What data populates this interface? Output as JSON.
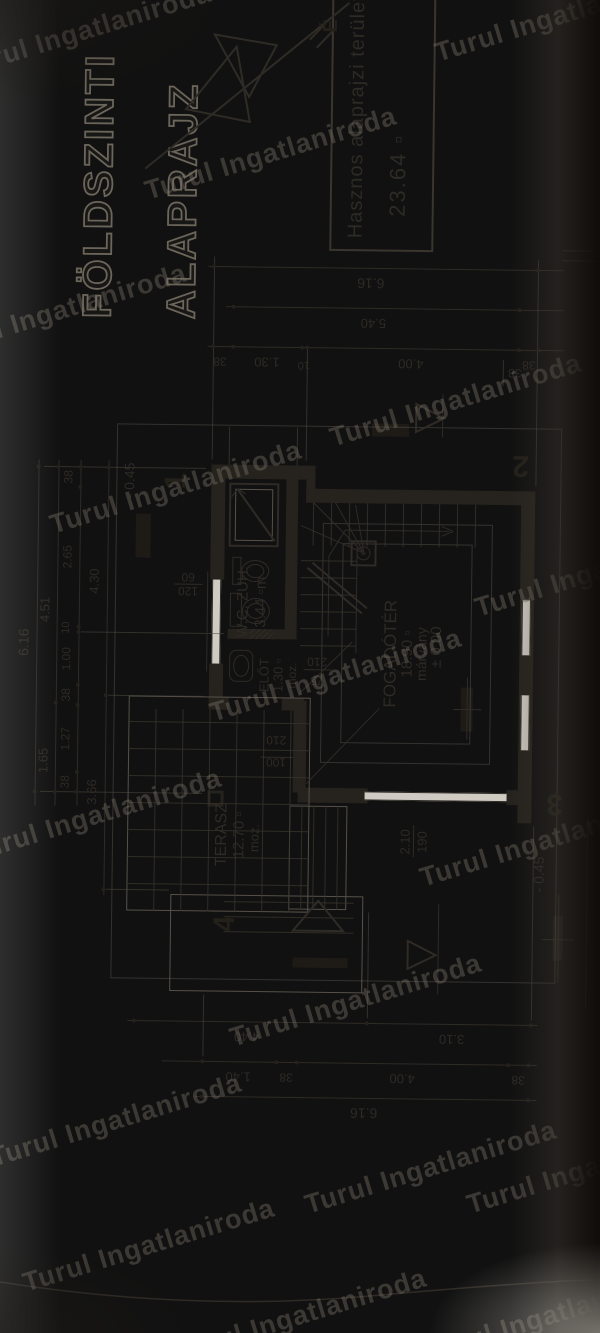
{
  "drawing_title": {
    "line1": "FÖLDSZINTI",
    "line2": "ALAPRAJZ"
  },
  "info_box": {
    "line1": "Hasznos alaprajzi terület",
    "line2": "23.64 ▫"
  },
  "watermark": {
    "text": "Turul Ingatlaniroda",
    "positions": [
      [
        -45,
        15
      ],
      [
        430,
        0
      ],
      [
        140,
        138
      ],
      [
        -70,
        295
      ],
      [
        325,
        385
      ],
      [
        45,
        472
      ],
      [
        470,
        555
      ],
      [
        205,
        660
      ],
      [
        -35,
        800
      ],
      [
        415,
        825
      ],
      [
        225,
        985
      ],
      [
        -15,
        1105
      ],
      [
        300,
        1152
      ],
      [
        18,
        1230
      ],
      [
        462,
        1152
      ],
      [
        170,
        1300
      ],
      [
        420,
        1300
      ]
    ]
  },
  "north_label": "É",
  "rooms": [
    {
      "name": "FOGADÓTÉR",
      "area": "18.90 ▫",
      "floor": "márvány",
      "level": "± 0.00"
    },
    {
      "name": "TERASZ",
      "area": "12.70 ▫",
      "floor": "moz."
    },
    {
      "name": "W.C. ZUH.",
      "area": "3.44 ▫m"
    },
    {
      "name": "ELŐT",
      "area": "1.30 ▫",
      "floor": "moz."
    }
  ],
  "section_markers": [
    "1",
    "2",
    "3",
    "4"
  ],
  "levels": [
    "- 0.45",
    "± 0.00",
    "- 0.45"
  ],
  "openings": [
    "75/210",
    "100/210",
    "120/60",
    "2.10/190"
  ],
  "dimension_chains": {
    "top": [
      [
        "6.16"
      ],
      [
        "1.65",
        "4.51"
      ],
      [
        "38",
        "1.27",
        "38",
        "1.00",
        "10",
        "2.65",
        "38"
      ],
      [
        "3.66",
        "4.30"
      ]
    ],
    "right": [
      [
        "6.16"
      ],
      [
        "5.40"
      ],
      [
        "38",
        "1.30",
        "10",
        "4.00",
        "38"
      ]
    ],
    "bottom": [
      [
        "4.40",
        "3.10"
      ],
      [
        "1.40",
        "38",
        "4.00",
        "38"
      ],
      [
        "6.16"
      ]
    ]
  },
  "plan": {
    "rects": [
      {
        "x": 856,
        "y": 198,
        "w": 14,
        "h": 100,
        "c": "w"
      },
      {
        "x": 833,
        "y": 293,
        "w": 37,
        "h": 9,
        "c": "w"
      },
      {
        "x": 833,
        "y": 293,
        "w": 14,
        "h": 229,
        "c": "w"
      },
      {
        "x": 515,
        "y": 508,
        "w": 332,
        "h": 14,
        "c": "w"
      },
      {
        "x": 533,
        "y": 288,
        "w": 15,
        "h": 70,
        "c": "w"
      },
      {
        "x": 533,
        "y": 497,
        "w": 15,
        "h": 25,
        "c": "w"
      },
      {
        "x": 633,
        "y": 198,
        "w": 38,
        "h": 14,
        "c": "w"
      },
      {
        "x": 755,
        "y": 198,
        "w": 115,
        "h": 14,
        "c": "w"
      },
      {
        "x": 625,
        "y": 198,
        "w": 13,
        "h": 20,
        "c": "w"
      },
      {
        "x": 625,
        "y": 271,
        "w": 13,
        "h": 22,
        "c": "w"
      },
      {
        "x": 543,
        "y": 283,
        "w": 92,
        "h": 13,
        "c": "w"
      },
      {
        "x": 696,
        "y": 273,
        "w": 174,
        "h": 12,
        "c": "w"
      },
      {
        "x": 696,
        "y": 216,
        "w": 10,
        "h": 62,
        "c": "w"
      },
      {
        "x": 900,
        "y": 358,
        "w": 13,
        "h": 37,
        "c": "blk"
      },
      {
        "x": 776,
        "y": 123,
        "w": 44,
        "h": 15,
        "c": "blk"
      },
      {
        "x": 378,
        "y": 545,
        "w": 45,
        "h": 10,
        "c": "blk"
      },
      {
        "x": 368,
        "y": 285,
        "w": 10,
        "h": 55,
        "c": "blk"
      },
      {
        "x": 606,
        "y": 450,
        "w": 44,
        "h": 12,
        "c": "blk"
      },
      {
        "x": 536,
        "y": 355,
        "w": 9,
        "h": 142,
        "c": "winv"
      },
      {
        "x": 671,
        "y": 200,
        "w": 84,
        "h": 9,
        "c": "winh"
      },
      {
        "x": 588,
        "y": 510,
        "w": 55,
        "h": 9,
        "c": "winh"
      },
      {
        "x": 683,
        "y": 510,
        "w": 55,
        "h": 9,
        "c": "winh"
      },
      {
        "x": 423,
        "y": 118,
        "w": 215,
        "h": 182,
        "c": "o"
      },
      {
        "x": 426,
        "y": 280,
        "w": 104,
        "h": 58,
        "c": "o"
      },
      {
        "x": 343,
        "y": 162,
        "w": 97,
        "h": 193,
        "c": "o"
      },
      {
        "x": 355,
        "y": 103,
        "w": 555,
        "h": 445,
        "c": "faint"
      },
      {
        "x": 573,
        "y": 310,
        "w": 240,
        "h": 170,
        "c": "faint"
      },
      {
        "x": 593,
        "y": 330,
        "w": 200,
        "h": 130,
        "c": "faint"
      },
      {
        "x": 788,
        "y": 216,
        "w": 64,
        "h": 50,
        "c": "ob"
      },
      {
        "x": 794,
        "y": 222,
        "w": 52,
        "h": 38,
        "c": "o"
      },
      {
        "x": 770,
        "y": 338,
        "w": 26,
        "h": 26,
        "c": "ob"
      },
      {
        "x": 528,
        "y": 198,
        "w": 16,
        "h": 16,
        "c": "col"
      },
      {
        "x": 750,
        "y": 220,
        "w": 28,
        "h": 9,
        "c": "o2"
      },
      {
        "x": 708,
        "y": 218,
        "w": 34,
        "h": 12,
        "c": "o2"
      },
      {
        "x": 653,
        "y": 218,
        "w": 32,
        "h": 24,
        "c": "o2",
        "r": 7
      },
      {
        "x": 696,
        "y": 238,
        "w": 10,
        "h": 24,
        "c": "hatch"
      },
      {
        "x": 1085,
        "y": 313,
        "w": 258,
        "h": 104,
        "c": "box"
      }
    ],
    "lines": [
      [
        527,
        25,
        873,
        25
      ],
      [
        527,
        45,
        873,
        45
      ],
      [
        527,
        67,
        873,
        67
      ],
      [
        438,
        95,
        873,
        95
      ],
      [
        1068,
        192,
        1068,
        548
      ],
      [
        1028,
        210,
        1028,
        548
      ],
      [
        988,
        192,
        988,
        548
      ],
      [
        313,
        120,
        313,
        530
      ],
      [
        273,
        155,
        273,
        530
      ],
      [
        238,
        188,
        238,
        530
      ],
      [
        541,
        30,
        541,
        192,
        1,
        "t2"
      ],
      [
        866,
        30,
        866,
        192,
        1,
        "t2"
      ],
      [
        638,
        97,
        638,
        192,
        1,
        "t2"
      ],
      [
        444,
        97,
        444,
        160,
        1,
        "t2"
      ],
      [
        701,
        69,
        701,
        212,
        1,
        "t2"
      ],
      [
        875,
        198,
        1078,
        198,
        1,
        "t2"
      ],
      [
        852,
        522,
        1078,
        522,
        1,
        "t2"
      ],
      [
        875,
        292,
        990,
        292,
        1,
        "t2"
      ],
      [
        318,
        524,
        512,
        524,
        1,
        "t2"
      ],
      [
        318,
        360,
        424,
        360,
        1,
        "t2"
      ],
      [
        278,
        196,
        340,
        196,
        1,
        "t2"
      ],
      [
        870,
        215,
        908,
        215,
        1,
        "t2"
      ],
      [
        870,
        283,
        908,
        283,
        1,
        "t2"
      ],
      [
        683,
        344,
        790,
        344
      ],
      [
        723,
        350,
        768,
        295,
        2
      ],
      [
        728,
        355,
        773,
        300,
        2
      ],
      [
        783,
        351,
        810,
        288
      ],
      [
        783,
        351,
        833,
        300
      ],
      [
        783,
        351,
        833,
        322
      ],
      [
        783,
        351,
        831,
        342
      ],
      [
        700,
        316,
        780,
        316
      ],
      [
        780,
        316,
        806,
        332
      ],
      [
        806,
        332,
        806,
        436
      ],
      [
        801,
        428,
        806,
        440
      ],
      [
        811,
        428,
        806,
        440
      ],
      [
        794,
        262,
        846,
        224,
        2
      ],
      [
        838,
        218,
        846,
        224
      ],
      [
        841,
        232,
        846,
        224
      ],
      [
        552,
        296,
        628,
        368
      ],
      [
        642,
        288,
        694,
        340
      ],
      [
        663,
        195,
        763,
        195
      ],
      [
        666,
        292,
        666,
        320
      ],
      [
        578,
        250,
        578,
        283
      ],
      [
        750,
        162,
        750,
        190
      ],
      [
        480,
        404,
        512,
        404
      ],
      [
        330,
        578,
        520,
        578,
        1,
        "t2"
      ],
      [
        1078,
        546,
        1078,
        600,
        1,
        "t2"
      ],
      [
        1088,
        546,
        1088,
        600,
        1,
        "t2"
      ],
      [
        1165,
        128,
        1333,
        330,
        2
      ],
      [
        1288,
        298,
        1305,
        314,
        2
      ],
      [
        1296,
        291,
        1313,
        307,
        2
      ],
      [
        356,
        550,
        444,
        550
      ],
      [
        399,
        534,
        399,
        566
      ],
      [
        598,
        456,
        660,
        456
      ],
      [
        628,
        442,
        628,
        470
      ],
      [
        900,
        428,
        943,
        428
      ],
      [
        343,
        430,
        433,
        430
      ],
      [
        952,
        488,
        978,
        488,
        1,
        "t2"
      ]
    ],
    "treads": [
      {
        "d": "v",
        "x": 690,
        "y": 288,
        "len": 56,
        "step": 17,
        "n": 6
      },
      {
        "d": "h",
        "x": 790,
        "y": 300,
        "len": 43,
        "step": 18,
        "n": 10
      },
      {
        "d": "h",
        "x": 426,
        "y": 292,
        "len": 104,
        "step": 12,
        "n": 4
      },
      {
        "d": "v",
        "x": 403,
        "y": 215,
        "len": 130,
        "step": 15,
        "n": 3
      }
    ],
    "grid": {
      "x": 423,
      "y": 118,
      "w": 202,
      "h": 182,
      "step": 27
    },
    "dots": [
      [
        541,
        25
      ],
      [
        866,
        25
      ],
      [
        541,
        45
      ],
      [
        630,
        45
      ],
      [
        866,
        45
      ],
      [
        541,
        67
      ],
      [
        561,
        67
      ],
      [
        628,
        67
      ],
      [
        648,
        67
      ],
      [
        701,
        67
      ],
      [
        706,
        67
      ],
      [
        846,
        67
      ],
      [
        866,
        67
      ],
      [
        444,
        95
      ],
      [
        638,
        95
      ],
      [
        866,
        95
      ],
      [
        1068,
        198
      ],
      [
        1068,
        522
      ],
      [
        1028,
        218
      ],
      [
        1028,
        504
      ],
      [
        988,
        198
      ],
      [
        988,
        218
      ],
      [
        988,
        287
      ],
      [
        988,
        292
      ],
      [
        988,
        504
      ],
      [
        988,
        524
      ],
      [
        313,
        127
      ],
      [
        313,
        360
      ],
      [
        313,
        524
      ],
      [
        273,
        196
      ],
      [
        273,
        270
      ],
      [
        273,
        290
      ],
      [
        273,
        502
      ],
      [
        273,
        522
      ],
      [
        238,
        196
      ],
      [
        238,
        522
      ],
      [
        783,
        351
      ]
    ],
    "ells": [
      [
        753,
        229,
        22,
        28
      ],
      [
        757,
        234,
        14,
        18
      ],
      [
        711,
        230,
        26,
        28
      ],
      [
        716,
        235,
        16,
        18
      ],
      [
        658,
        222,
        22,
        16
      ],
      [
        776,
        344,
        14,
        14
      ]
    ],
    "polys": [
      "905,402 933,402 919,430",
      "368,400 396,400 382,428",
      "405,335 435,310 405,285",
      "1225,168 1288,218 1213,232",
      "1238,231 1300,196 1290,258"
    ],
    "texts": [
      [
        "W.C. ZUH.",
        733,
        231,
        15
      ],
      [
        "3.44 ▫m",
        733,
        249,
        15
      ],
      [
        "ELŐT",
        660,
        253,
        13
      ],
      [
        "1.30 ▫",
        660,
        267,
        13
      ],
      [
        "moz.",
        660,
        281,
        12
      ],
      [
        "FOGADÓTÉR",
        683,
        379,
        17
      ],
      [
        "18.90 ▫",
        683,
        396,
        15
      ],
      [
        "márvány",
        683,
        410,
        14
      ],
      [
        "± 0.00",
        690,
        425,
        15
      ],
      [
        "TERASZ",
        500,
        213,
        16
      ],
      [
        "12.70 ▫",
        500,
        230,
        15
      ],
      [
        "moz.",
        497,
        245,
        13
      ],
      [
        "6.16",
        690,
        12,
        14
      ],
      [
        "1.65",
        572,
        33,
        13
      ],
      [
        "4.51",
        723,
        33,
        13
      ],
      [
        "38",
        551,
        55,
        12
      ],
      [
        "1.27",
        594,
        55,
        12
      ],
      [
        "38",
        638,
        55,
        12
      ],
      [
        "1.00",
        674,
        55,
        12
      ],
      [
        "10",
        705,
        55,
        11
      ],
      [
        "2.65",
        776,
        55,
        12
      ],
      [
        "38",
        856,
        55,
        12
      ],
      [
        "3.66",
        541,
        82,
        13
      ],
      [
        "4.30",
        752,
        82,
        13
      ],
      [
        "6.16",
        1053,
        355,
        14,
        -90
      ],
      [
        "5.40",
        1013,
        358,
        13,
        -90
      ],
      [
        "38",
        973,
        205,
        12,
        -90
      ],
      [
        "1.30",
        973,
        252,
        13,
        -90
      ],
      [
        "10",
        971,
        289,
        11,
        -90
      ],
      [
        "4.00",
        973,
        396,
        13,
        -90
      ],
      [
        "38",
        973,
        514,
        12,
        -90
      ],
      [
        "4.40",
        298,
        240,
        13,
        -90
      ],
      [
        "3.10",
        298,
        445,
        13,
        -90
      ],
      [
        "1.40",
        258,
        232,
        13,
        -90
      ],
      [
        "38",
        258,
        280,
        12,
        -90
      ],
      [
        "4.00",
        258,
        396,
        13,
        -90
      ],
      [
        "38",
        258,
        512,
        12,
        -90
      ],
      [
        "6.16",
        223,
        358,
        14,
        -90
      ],
      [
        "75",
        655,
        306,
        12,
        -90
      ],
      [
        "210",
        674,
        306,
        12,
        -90
      ],
      [
        "100",
        573,
        266,
        12,
        -90
      ],
      [
        "210",
        595,
        266,
        12,
        -90
      ],
      [
        "120",
        743,
        176,
        12,
        -90
      ],
      [
        "60",
        757,
        176,
        12,
        -90
      ],
      [
        "2.10",
        495,
        396,
        13
      ],
      [
        "190",
        495,
        413,
        13
      ],
      [
        "- 0.45",
        853,
        116,
        14
      ],
      [
        "- 0.45",
        464,
        530,
        14
      ],
      [
        "38",
        965,
        500,
        12,
        -90
      ],
      [
        "1",
        853,
        163,
        30,
        0,
        "mk"
      ],
      [
        "2",
        873,
        507,
        30,
        -90,
        "mk"
      ],
      [
        "3",
        535,
        545,
        30,
        -90,
        "mk"
      ],
      [
        "4",
        411,
        217,
        30,
        0,
        "mk"
      ],
      [
        "É",
        1310,
        312,
        20,
        0,
        "mk"
      ]
    ]
  }
}
